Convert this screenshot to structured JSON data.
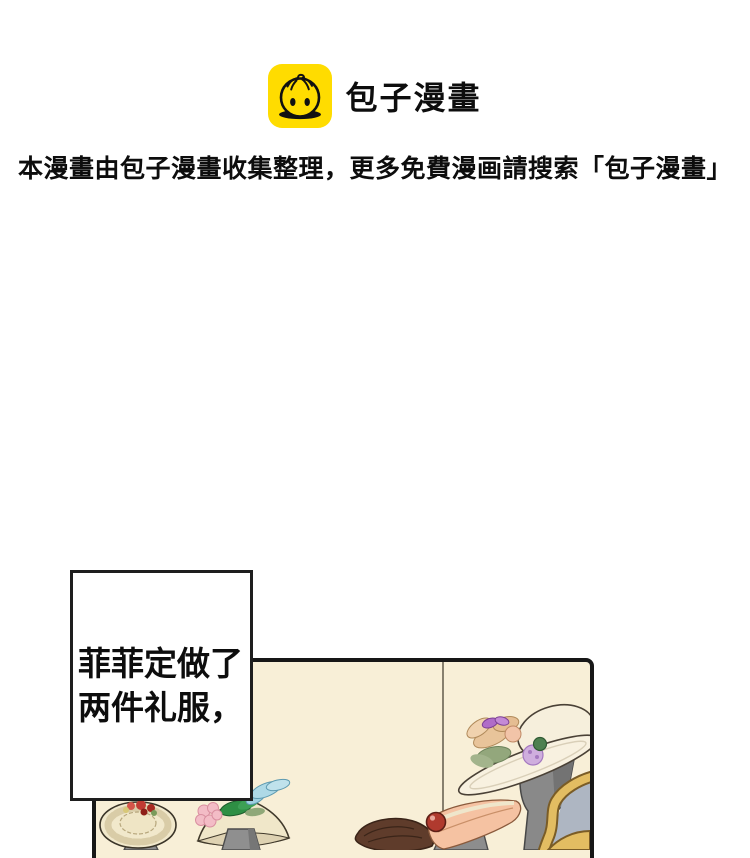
{
  "brand": {
    "app_name": "包子漫畫",
    "icon": "baozi-bun-icon"
  },
  "notice": "本漫畫由包子漫畫收集整理，更多免費漫画請搜索「包子漫畫」",
  "comic": {
    "caption": {
      "full_text": "菲菲定做了两件礼服，",
      "line1": "菲菲定做了",
      "line2": "两件礼服，"
    },
    "panel": {
      "art_items": [
        "ruffled-hat-on-stand",
        "cone-hat-with-pink-flowers-and-blue-feather",
        "hanging-cord-with-red-bauble",
        "salmon-hat-with-brown-plume-on-stand",
        "white-wide-brim-hat-with-flowers-on-stand",
        "gilded-chair-back-corner"
      ]
    }
  },
  "colors": {
    "page_background": "#ffffff",
    "text": "#0d0d0d",
    "logo_yellow": "#ffdc00",
    "panel_cream": "#f8efd7",
    "panel_border": "#171717",
    "hat_cream": "#f1e8cb",
    "stand_gray": "#8d8d8d",
    "salmon": "#f5c2a2",
    "plume_brown": "#5f3c2b",
    "bauble_red": "#b03a2e",
    "feather_blue": "#aed9e6",
    "flower_pink": "#f3bcc6",
    "leaf_green": "#2e8f44",
    "bow_purple": "#b06cc8",
    "frame_gold": "#e3bd62",
    "chair_bluegray": "#aeb6c2"
  }
}
